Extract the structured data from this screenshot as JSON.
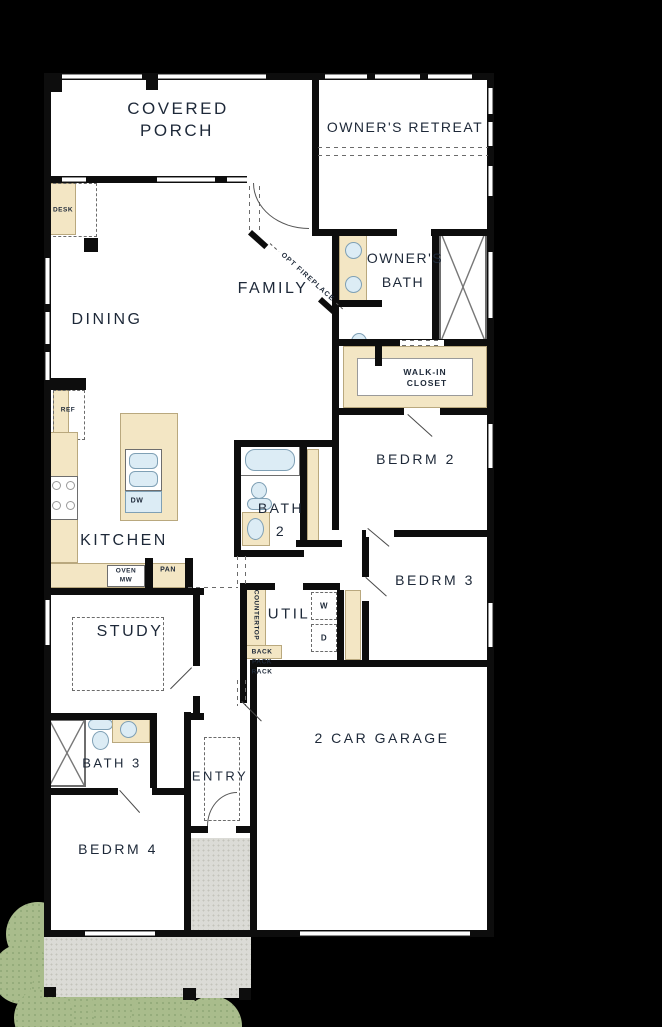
{
  "plan": {
    "rooms": {
      "covered_porch_1": "COVERED",
      "covered_porch_2": "PORCH",
      "owners_retreat": "OWNER'S RETREAT",
      "family": "FAMILY",
      "dining": "DINING",
      "owners_bath_1": "OWNER'S",
      "owners_bath_2": "BATH",
      "walkin_1": "WALK-IN",
      "walkin_2": "CLOSET",
      "bedrm2": "BEDRM 2",
      "bath2_1": "BATH",
      "bath2_2": "2",
      "kitchen": "KITCHEN",
      "bedrm3": "BEDRM 3",
      "util": "UTIL",
      "study": "STUDY",
      "garage": "2 CAR GARAGE",
      "bath3": "BATH 3",
      "entry": "ENTRY",
      "bedrm4": "BEDRM 4"
    },
    "labels": {
      "desk": "DESK",
      "ref": "REF",
      "dw": "DW",
      "oven": "OVEN",
      "mw": "MW",
      "pan": "PAN",
      "countertop": "COUNTERTOP",
      "back": "BACK",
      "pack": "PACK",
      "rack": "RACK",
      "washer": "W",
      "dryer": "D",
      "opt_fireplace": "OPT FIREPLACE"
    },
    "colors": {
      "background": "#000000",
      "wall": "#0d0d0d",
      "floor": "#ffffff",
      "cabinetry": "#f3e6c4",
      "fixture_fill": "#dcecf5",
      "walkway": "#dbdbd6",
      "shrub": "#a9bc8c",
      "label_text": "#1d2838"
    }
  }
}
